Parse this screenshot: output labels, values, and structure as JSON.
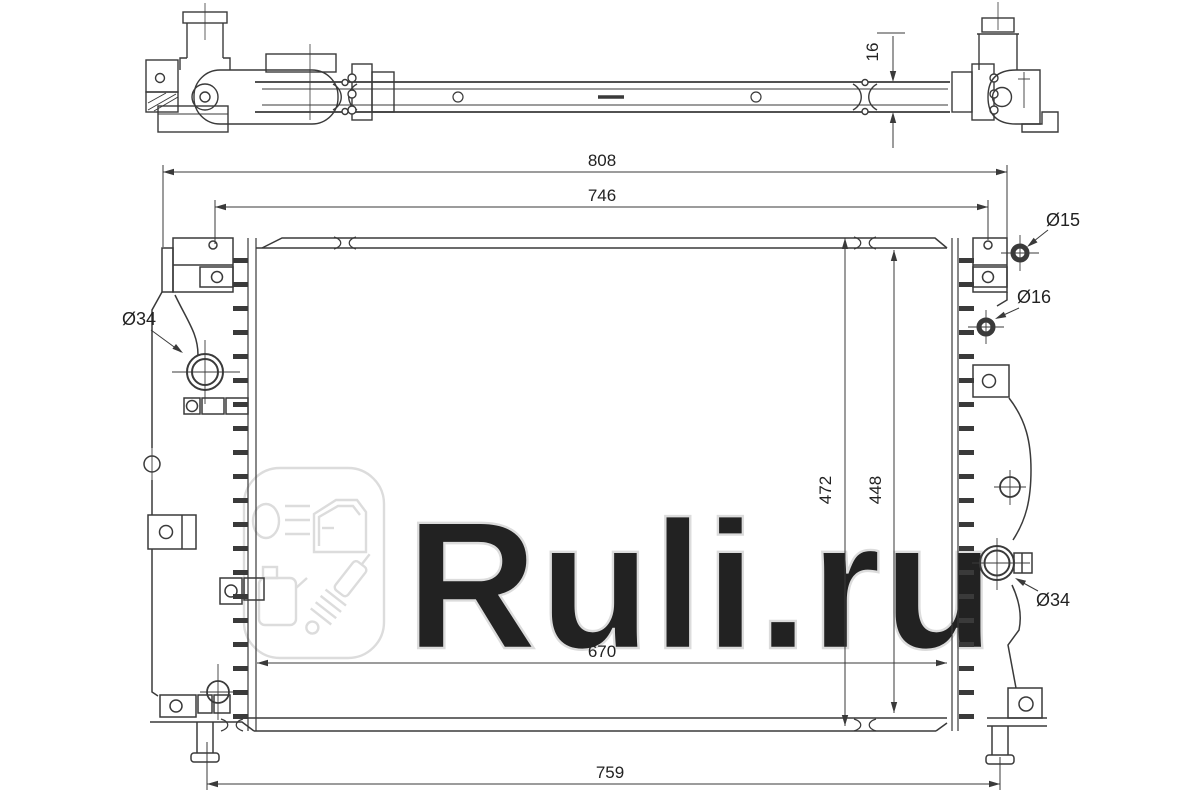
{
  "page": {
    "background": "#ffffff"
  },
  "drawing": {
    "subject": "radiator-engineering-drawing",
    "line_color": "#3a3a3a",
    "watermark": {
      "text": "Ruli.ru",
      "color": "#dcdcdc"
    },
    "labels": {
      "top_thickness": "16",
      "overall_width": "808",
      "mount_span": "746",
      "overall_height": "472",
      "core_height": "448",
      "core_width": "670",
      "pin_span": "759",
      "inlet_diameter": "Ø34",
      "top_pin_diameter": "Ø15",
      "mid_pin_diameter": "Ø16",
      "outlet_diameter": "Ø34"
    }
  }
}
